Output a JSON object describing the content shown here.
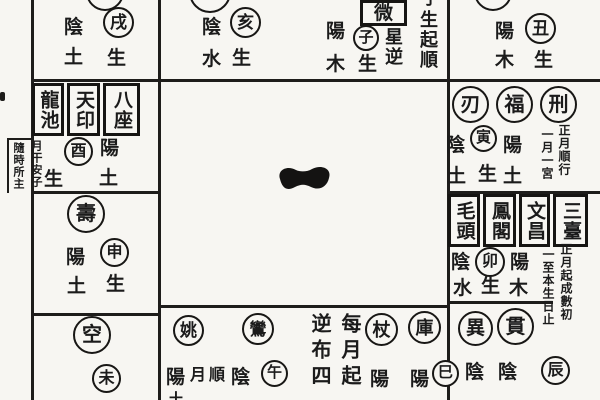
{
  "palaces": {
    "xu": {
      "branch": "戌",
      "polarity": "陰",
      "element": "土",
      "sheng": "生"
    },
    "hai": {
      "branch": "亥",
      "polarity": "陰",
      "element": "水",
      "sheng": "生"
    },
    "zi": {
      "star_box": "微",
      "star_col": "星逆",
      "branch": "子",
      "sheng": "生",
      "polarity": "陽",
      "element": "木",
      "note_col": "生起順",
      "note_col_partial": "子"
    },
    "chou": {
      "branch": "丑",
      "polarity": "陽",
      "element": "木",
      "sheng": "生"
    },
    "you": {
      "boxes": [
        "龍池",
        "天印",
        "八座"
      ],
      "note_right": "月干安子",
      "note_left": "隨時所主",
      "branch": "酉",
      "polarity": "陽",
      "sheng": "生",
      "element": "土"
    },
    "shen": {
      "star": "壽",
      "polarity": "陽",
      "branch": "申",
      "element": "土",
      "sheng": "生"
    },
    "wei": {
      "star": "空",
      "branch": "未"
    },
    "yin": {
      "stars": [
        "刃",
        "福",
        "刑"
      ],
      "pol_left": "陰",
      "branch": "寅",
      "pol_right": "陽",
      "note_right": "正月順行",
      "note_left": "一月一宮",
      "el_left": "土",
      "sheng": "生",
      "el_right": "土"
    },
    "mao": {
      "boxes": [
        "毛頭",
        "鳳閣",
        "文昌",
        "三臺"
      ],
      "pol_left": "陰",
      "branch": "卯",
      "pol_right": "陽",
      "note_right": "正月起成數初",
      "note_left": "一至本生日止",
      "el_left": "水",
      "sheng": "生",
      "el_right": "木"
    },
    "chen": {
      "stars": [
        "異",
        "貫"
      ],
      "pol1": "陰",
      "pol2": "陰",
      "branch": "辰"
    },
    "wu": {
      "stars": [
        "姚",
        "鸞"
      ],
      "pol_left": "陽",
      "note_top": [
        "月",
        "順"
      ],
      "pol_right": "陰",
      "branch": "午",
      "partial_bottom": "土"
    },
    "si": {
      "note_left_col": "逆布四",
      "note_right_col": "每月起",
      "stars": [
        "杖",
        "庫"
      ],
      "pol1": "陽",
      "pol2": "陽",
      "branch": "巳"
    }
  }
}
